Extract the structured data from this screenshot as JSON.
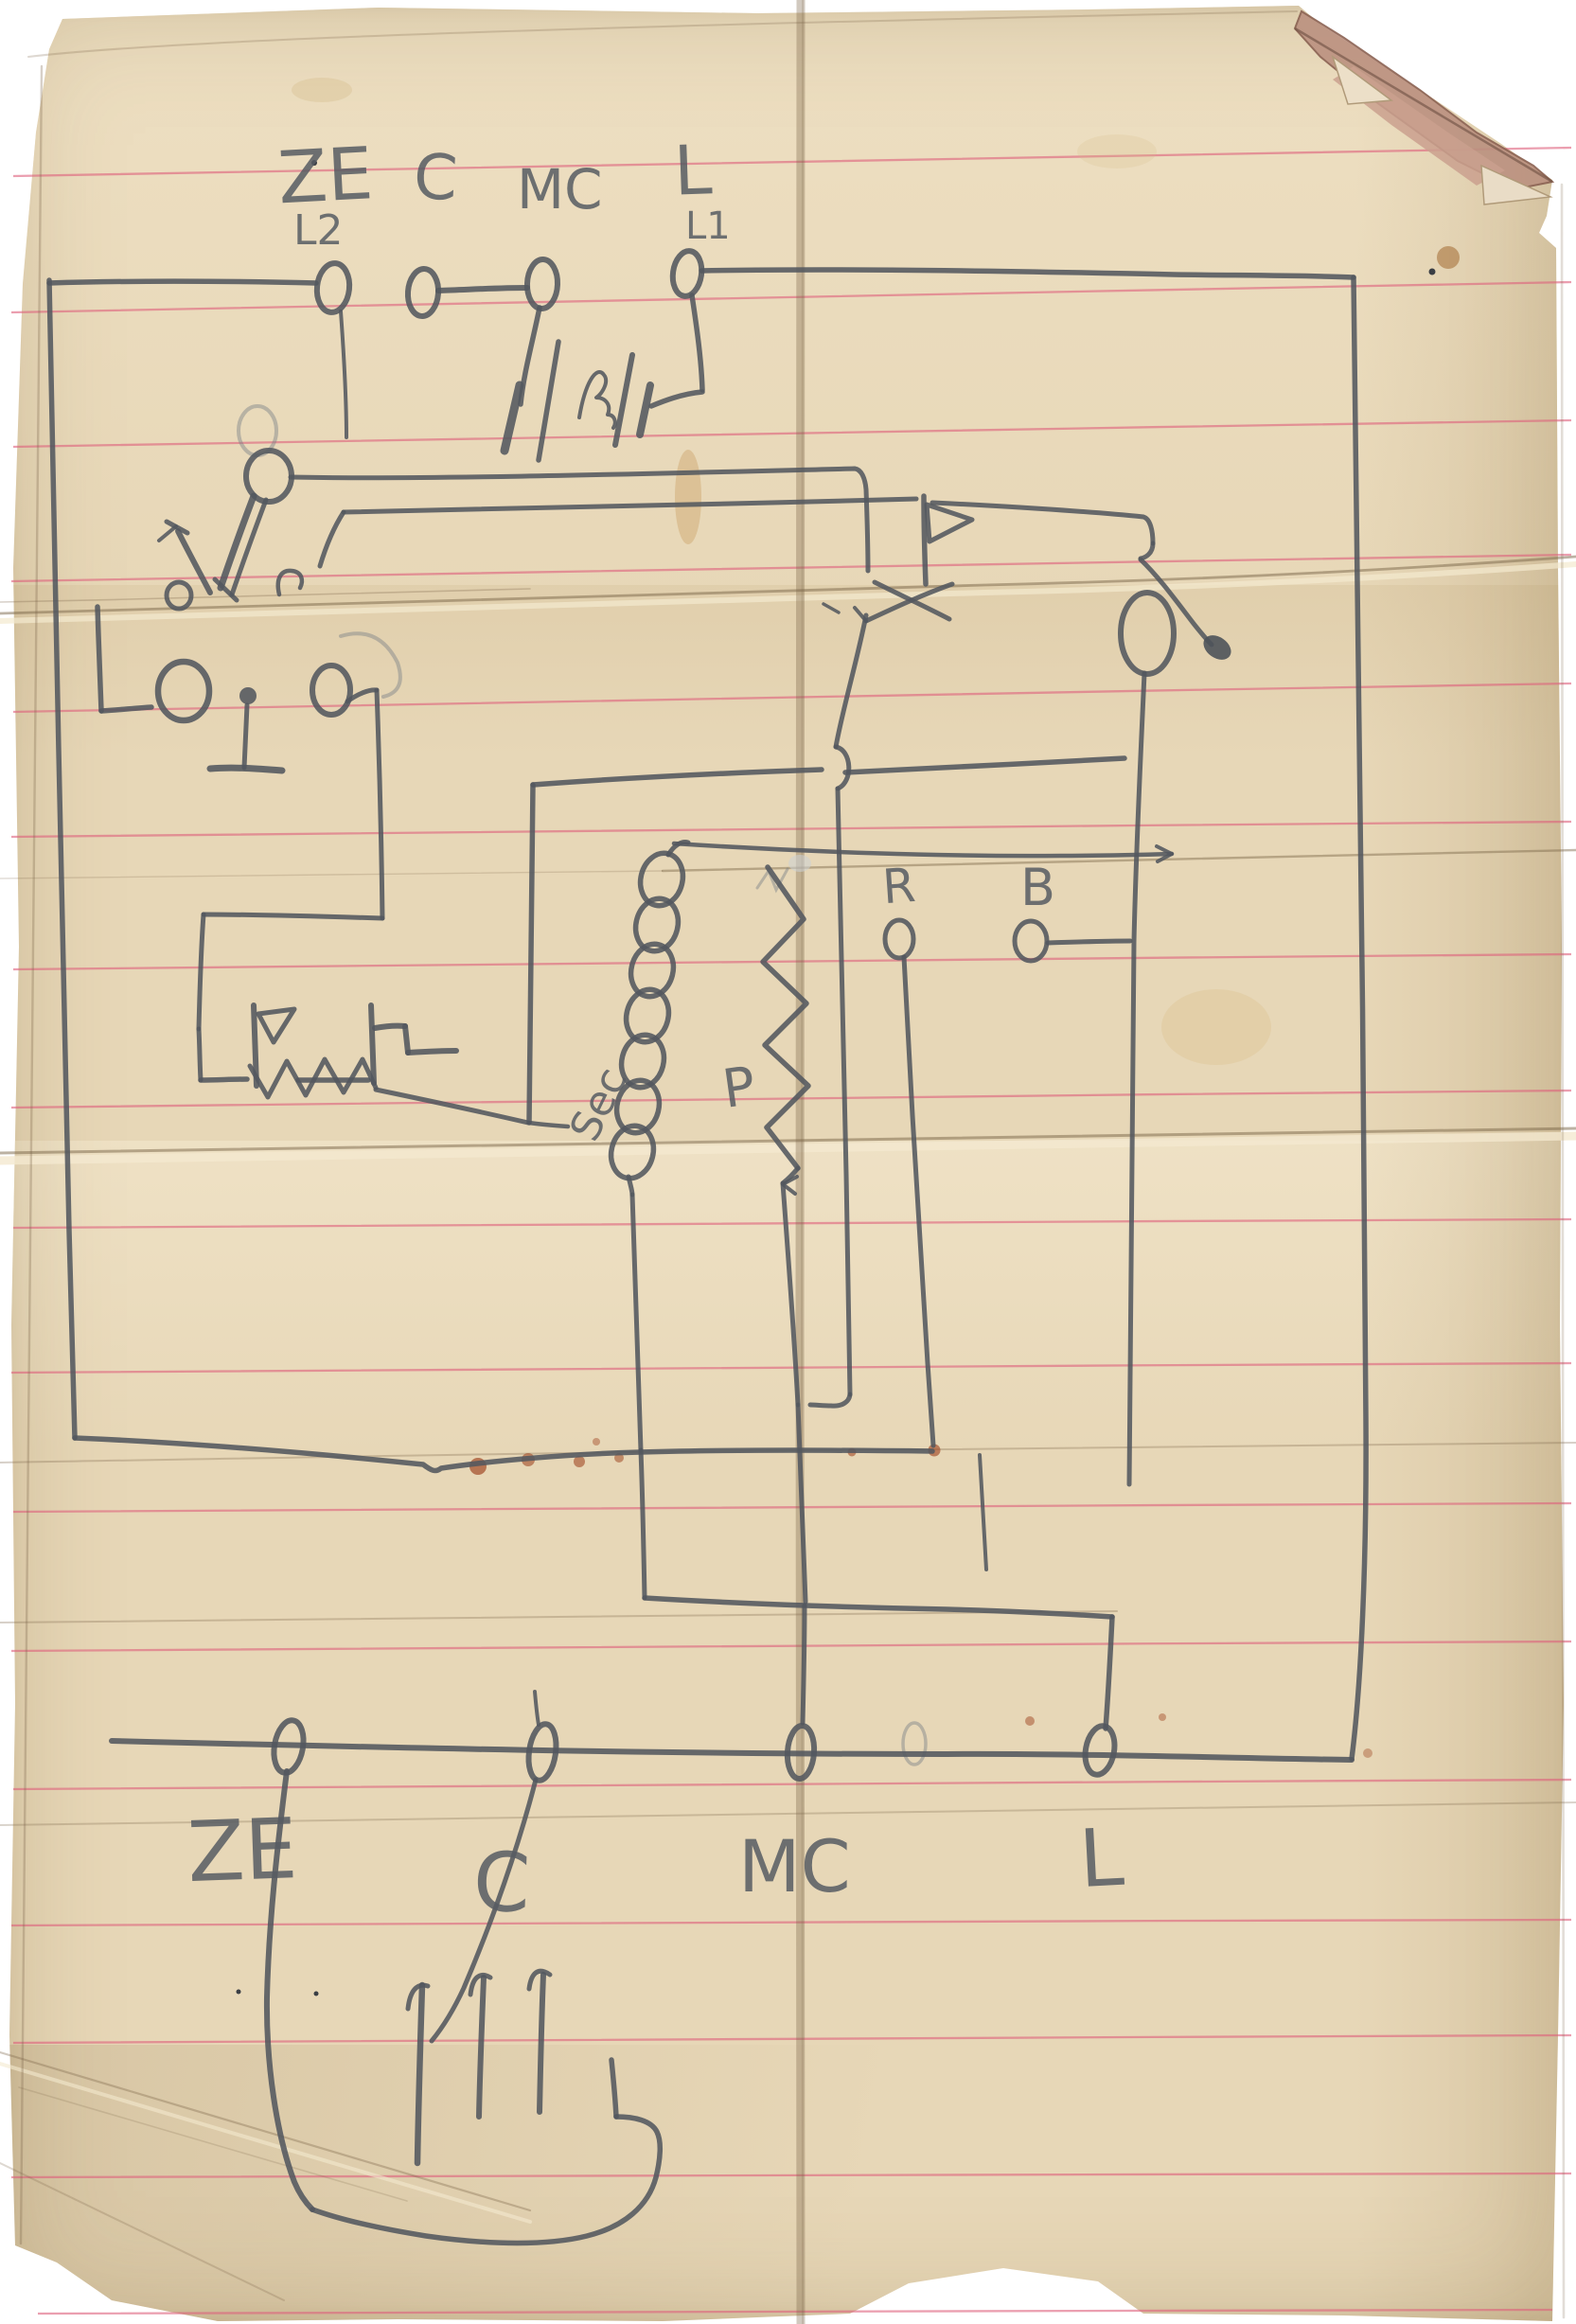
{
  "labels": {
    "top": {
      "ze": "ZE",
      "l2": "L2",
      "c": "C",
      "mc": "MC",
      "l": "L",
      "l1": "L1"
    },
    "middle": {
      "r": "R",
      "b": "B",
      "sec": "Sec",
      "p": "P"
    },
    "bottom": {
      "ze": "ZE",
      "c": "C",
      "mc": "MC",
      "l": "L"
    }
  },
  "colors": {
    "pencil": "#53585f",
    "rule_line": "#dd5f7b",
    "paper": "#e7d7b7",
    "paper_shadow": "#c9b691",
    "stain": "#c08a45",
    "rust": "#a14a26",
    "background": "#ffffff"
  }
}
